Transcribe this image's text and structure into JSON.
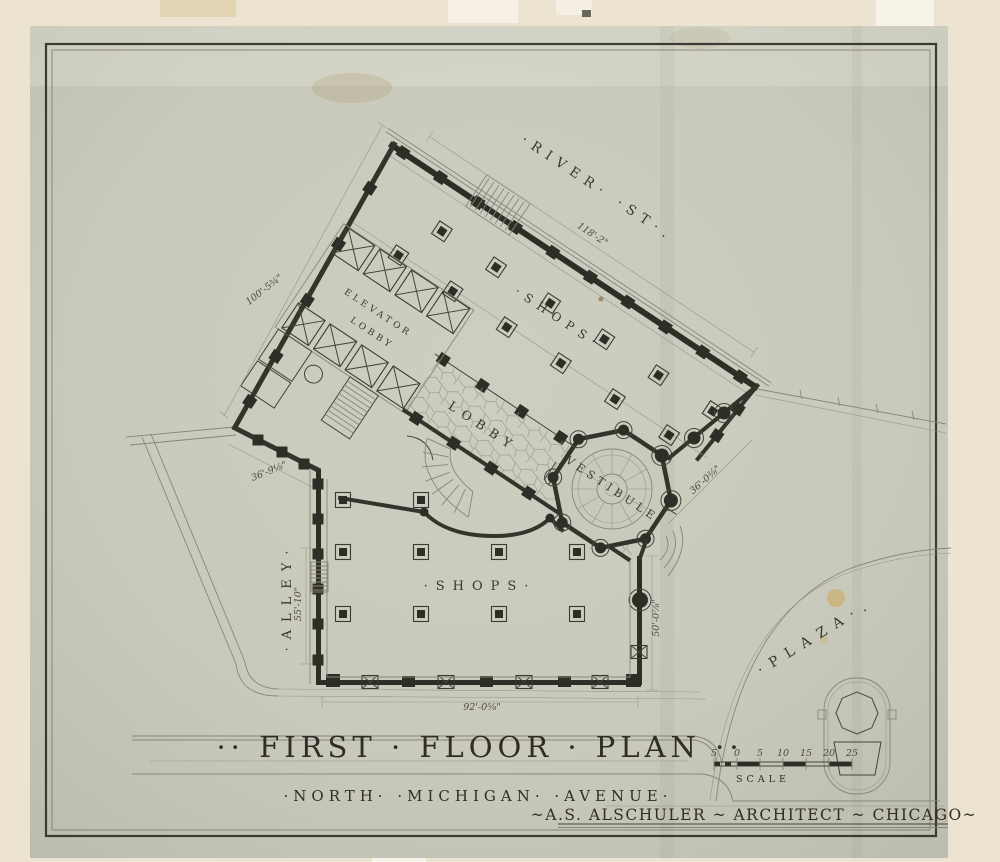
{
  "drawing": {
    "title": "··  FIRST  ·  FLOOR  ·  PLAN  ··",
    "subtitle": "·NORTH·  ·MICHIGAN·  ·AVENUE·",
    "credit": "~A.S. ALSCHULER ~ ARCHITECT ~ CHICAGO~",
    "scale_label": "SCALE",
    "scale_ticks": [
      "5",
      "0",
      "5",
      "10",
      "15",
      "20",
      "25"
    ]
  },
  "streets": {
    "river": "·RIVER·  ·ST·.",
    "alley": "·ALLEY·",
    "plaza": "·PLAZA·."
  },
  "rooms": {
    "shops_upper": "·SHOPS·",
    "shops_lower": "·SHOPS·",
    "lobby": "LOBBY",
    "elevator_line1": "ELEVATOR",
    "elevator_line2": "LOBBY",
    "vestibule": "VESTIBULE"
  },
  "dimensions": {
    "river_frontage": "118'-2\"",
    "northwest_side": "100'-5¾\"",
    "alley_splay": "36'-9⅛\"",
    "alley_side": "55'-10\"",
    "avenue_frontage": "92'-0⅝\"",
    "plaza_side": "50'-0⅞\"",
    "vestibule_splay": "36'-0⅜\""
  },
  "colors": {
    "mat": "#ece4d0",
    "sheet": "#c9cabc",
    "ink": "#35342c",
    "light_line": "#87867a",
    "stain": "#d0b269"
  }
}
